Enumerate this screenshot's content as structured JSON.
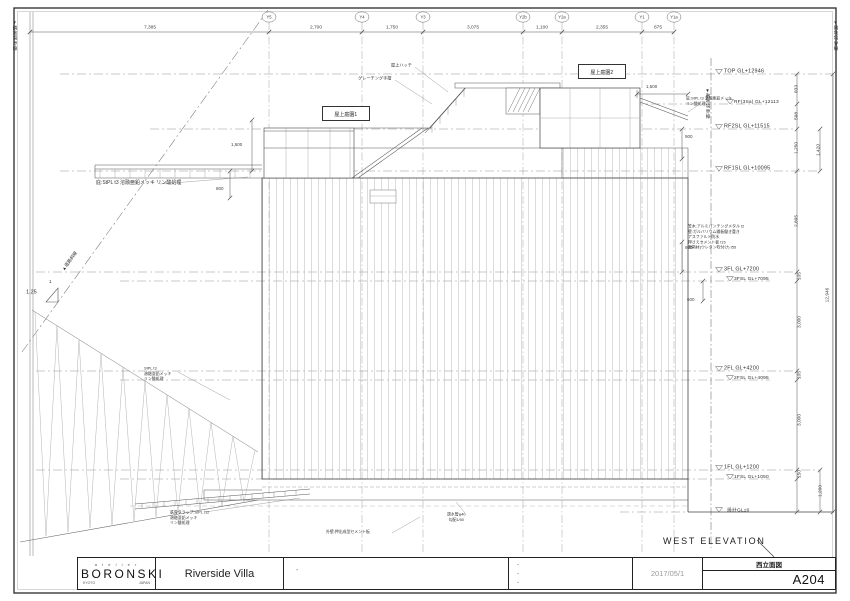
{
  "sheet": {
    "firm_small": "a  t  e  l  i  e  r",
    "firm": "BORONSKI",
    "firm_city": "KYOTO",
    "firm_country": "JAPAN",
    "project": "Riverside Villa",
    "date": "2017/05/1",
    "drawing_title_jp": "西立面図",
    "drawing_no": "A204",
    "drawing_title_en": "WEST ELEVATION",
    "revision_marks": [
      "-",
      "-",
      "-",
      "-"
    ]
  },
  "grid": {
    "bubbles": [
      "Y5",
      "Y4",
      "Y3",
      "Y2b",
      "Y2a",
      "Y1",
      "Y1a"
    ],
    "top_dims": [
      "7,385",
      "2,700",
      "1,750",
      "3,075",
      "1,100",
      "2,355",
      "875"
    ]
  },
  "levels": [
    {
      "label": "TOP  GL+12946"
    },
    {
      "label": "RF(3Sa)  GL+12113"
    },
    {
      "label": "RF2SL  GL+11515"
    },
    {
      "label": "RF1SL  GL+10095"
    },
    {
      "label": "3FL  GL+7200"
    },
    {
      "label": "3FSL  GL+7095"
    },
    {
      "label": "2FL  GL+4200"
    },
    {
      "label": "2FSL  GL+4095"
    },
    {
      "label": "1FL  GL+1200"
    },
    {
      "label": "1FSL  GL+1050"
    },
    {
      "label": "設計GL±0"
    }
  ],
  "dims": {
    "right_chain": [
      "833",
      "598",
      "1,250",
      "1,420",
      "2,895",
      "105",
      "3,000",
      "105",
      "3,000",
      "150",
      "1,200"
    ],
    "total_height": "12,946",
    "misc": {
      "a": "900",
      "b": "900",
      "c": "600",
      "d": "1,500",
      "e": "800",
      "f": "1,500"
    }
  },
  "annotations": {
    "roof_hatch": "屋上ハッチ",
    "grating": "グレーチング手摺",
    "roof_garden_1": "屋上庭園1",
    "roof_garden_2": "屋上庭園2",
    "canopy_spec": "庇:StPL t3  溶融亜鉛メッキ  リン酸処理",
    "canopy_spec_r1": "庇:StPL t3 溶融亜鉛メッキ",
    "canopy_spec_r2": "リン酸処理",
    "wall_spec": [
      "笠木:アルミパンチングメタル t2",
      "壁:ガルバリウム鋼板働き葺き",
      "アスファルト防水",
      "押さえセメント板 t15",
      "断熱材(ウレタン吹付け) t55"
    ],
    "slope_ratio": "1.25",
    "slope_unit": "1",
    "road_line": "▲道路斜線",
    "hill_spec": [
      "StPL t3",
      "溶融亜鉛メッキ",
      "リン酸処理"
    ],
    "ladder_spec": [
      "鉄骨タラップ:StPL t12",
      "溶融亜鉛メッキ",
      "リン酸処理"
    ],
    "drain_spec": [
      "透水管φ40",
      "勾配1/50"
    ],
    "ext_wall_spec": "外壁:押出成型セメント板",
    "boundary_left": "▼隣地境界線",
    "boundary_right": "▼隣地境界線",
    "boundary_site": "▼敷地境界線"
  }
}
